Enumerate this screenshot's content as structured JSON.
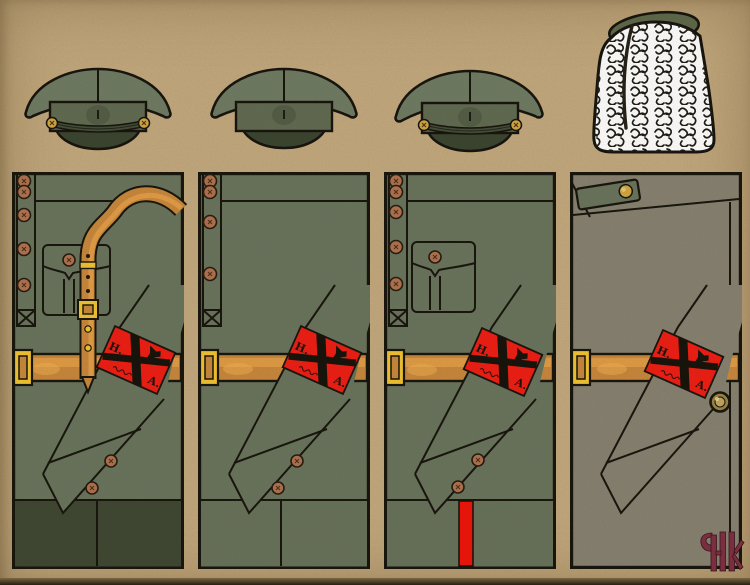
{
  "plate": {
    "background": "#c3a87d",
    "armband": {
      "letter_left": "Н.",
      "letter_right": "А.",
      "color": "#ee1c12"
    },
    "palette": {
      "tunic": "#68735c",
      "tunic_bottom": "#667059",
      "breeches_dark": "#3d4531",
      "greatcoat": "#868070",
      "cap_crown": "#6e7a62",
      "cap_band": "#5f6a50",
      "visor": "#3f4a33",
      "belt": "#c8873b",
      "belt_highlight": "#e8a149",
      "buckle_yellow": "#f2c32f",
      "button_bronze": "#b0714e",
      "brass": "#d2a73f",
      "stripe_red": "#ee1208",
      "fur_white": "#ffffff",
      "fur_top_green": "#5c6749",
      "logo_maroon": "#7b2e3e",
      "outline": "#15130b"
    },
    "figures": [
      {
        "hat": "peaked-cap-with-chinstrap",
        "garment": "tunic-with-sam-browne-strap",
        "details": "breast pocket, five-button placket, dark breeches"
      },
      {
        "hat": "peaked-cap-plain-band",
        "garment": "plain-tunic",
        "details": "four-button placket"
      },
      {
        "hat": "peaked-cap-with-chinstrap",
        "garment": "tunic-with-breast-pocket",
        "details": "red trouser stripe"
      },
      {
        "hat": "white-fur-papakha",
        "garment": "greatcoat-with-shoulder-tab",
        "details": "brass buttons, fly front"
      }
    ]
  }
}
